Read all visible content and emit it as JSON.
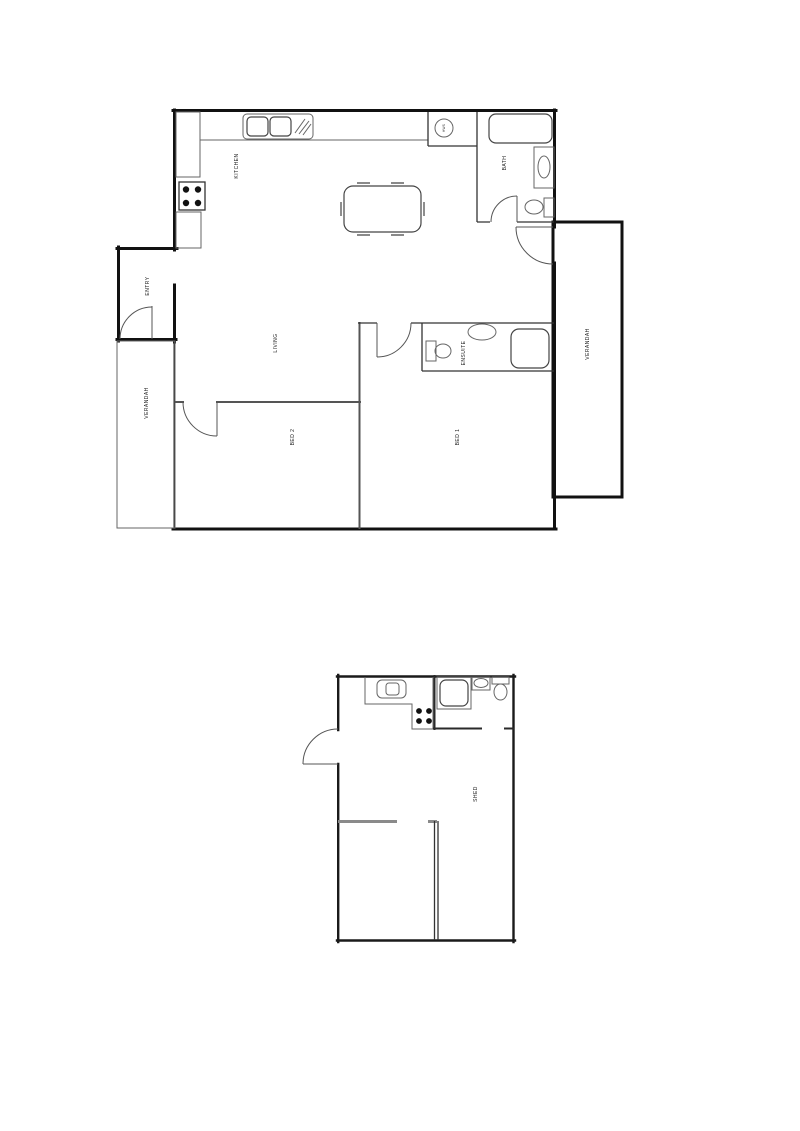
{
  "page": {
    "background": "#ffffff",
    "description": "architectural floor plans: main house and shed"
  },
  "colors": {
    "outer_wall": "#111111",
    "interior_wall": "#555555",
    "gray_wall": "#8a8a8a",
    "fixture_line": "#666666",
    "label_text": "#222222"
  },
  "main_floorplan": {
    "rooms": {
      "kitchen": "KITCHEN",
      "bath": "BATH",
      "living": "LIVING",
      "ensuite": "ENSUITE",
      "bed1": "BED 1",
      "bed2": "BED 2",
      "entry": "ENTRY",
      "verandah_left": "VERANDAH",
      "verandah_right": "VERANDAH"
    },
    "fixtures": {
      "hot_water": "HWS"
    }
  },
  "shed_floorplan": {
    "rooms": {
      "shed": "SHED"
    }
  }
}
